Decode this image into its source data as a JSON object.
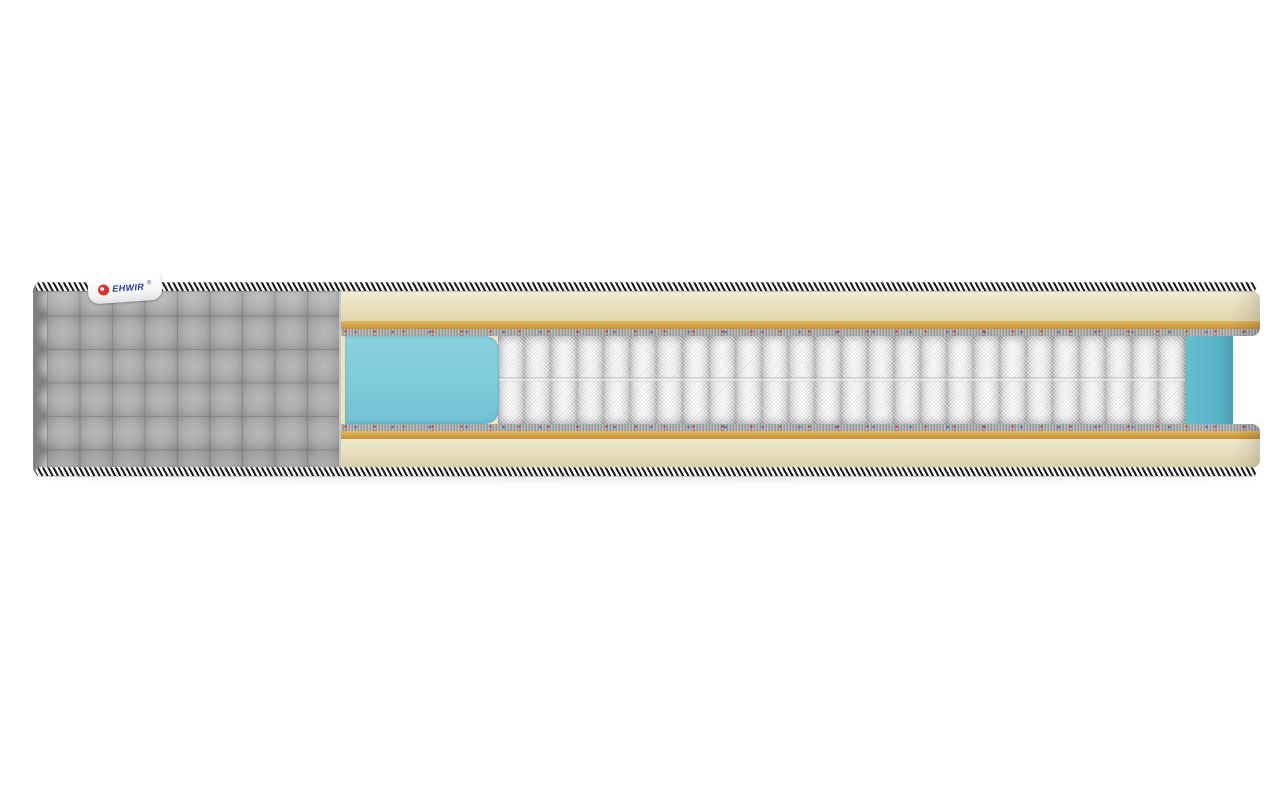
{
  "scene": {
    "description": "3D product render of a mattress shown in cutaway cross-section on a white background",
    "background_color": "#ffffff"
  },
  "brand_tag": {
    "text": "EHWIR",
    "registered_mark": "®",
    "text_color": "#2a3a8e",
    "logo": "red-circle-emblem",
    "logo_color": "#d5342b",
    "bg_color": "#ffffff"
  },
  "mattress": {
    "cover": {
      "name": "gray quilted fabric cover",
      "color": "#a6a6a6",
      "quilt_pattern": "square quilting",
      "edge": "scalloped rounded left edge"
    },
    "edge_tape": {
      "name": "black and white diagonally striped edge piping",
      "stripe_dark": "#181818",
      "stripe_light": "#f7f7f7",
      "positions": [
        "top",
        "bottom"
      ]
    },
    "layers_top_to_bottom": [
      {
        "name": "striped edge tape",
        "color": "#181818"
      },
      {
        "name": "soft foam comfort layer",
        "color": "#eae3c0"
      },
      {
        "name": "thermobonded pad",
        "color": "#d2a246"
      },
      {
        "name": "felt insulator pad",
        "color": "#a4a5a7"
      },
      {
        "name": "foam cut block (cross-section face)",
        "color": "#7cc9d9"
      },
      {
        "name": "independent pocket spring unit",
        "color": "#ededee",
        "visible_spring_count": 26
      },
      {
        "name": "felt insulator pad",
        "color": "#a4a5a7"
      },
      {
        "name": "thermobonded pad",
        "color": "#d2a246"
      },
      {
        "name": "soft foam comfort layer",
        "color": "#e7dfbd"
      },
      {
        "name": "striped edge tape",
        "color": "#181818"
      }
    ],
    "side_foam_wall_color": "#58b2c5"
  }
}
